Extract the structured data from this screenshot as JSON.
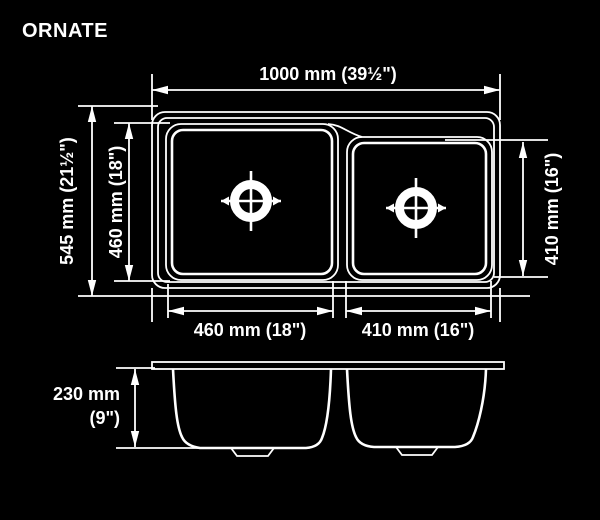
{
  "title": "ORNATE",
  "colors": {
    "background": "#000000",
    "line": "#ffffff",
    "text": "#ffffff"
  },
  "top_view": {
    "overall_width": "1000 mm (39½\")",
    "overall_depth": "545 mm (21½\")",
    "left_bowl_depth": "460 mm (18\")",
    "right_bowl_depth": "410 mm (16\")",
    "left_bowl_width": "460 mm (18\")",
    "right_bowl_width": "410 mm (16\")"
  },
  "side_view": {
    "bowl_depth_mm": "230 mm",
    "bowl_depth_in": "(9\")"
  },
  "icons": {
    "drain_left": "drain-crosshair-icon",
    "drain_right": "drain-crosshair-icon"
  }
}
